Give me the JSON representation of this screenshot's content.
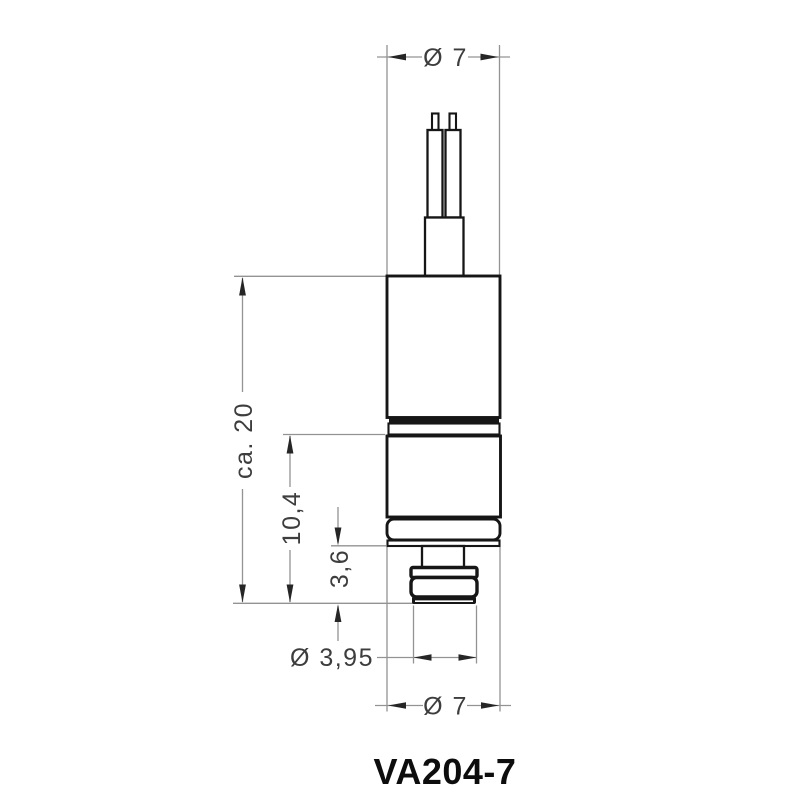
{
  "drawing": {
    "title": "VA204-7",
    "type_label": "dimensioned technical drawing of cylindrical valve/sensor component with two wire leads",
    "colors": {
      "background": "#ffffff",
      "outline": "#161616",
      "dimension_lines": "#939393",
      "dimension_text": "#3d3d3d",
      "title_text": "#0d0d0d"
    },
    "dimensions": {
      "top_diameter": "Ø 7",
      "overall_length": "ca. 20",
      "lower_length": "10,4",
      "tip_length": "3,6",
      "tip_diameter": "Ø 3,95",
      "body_diameter": "Ø 7"
    },
    "values_mm": {
      "top_diameter": 7,
      "overall_length": 20,
      "lower_length": 10.4,
      "tip_length": 3.6,
      "tip_diameter": 3.95,
      "body_diameter": 7
    }
  }
}
